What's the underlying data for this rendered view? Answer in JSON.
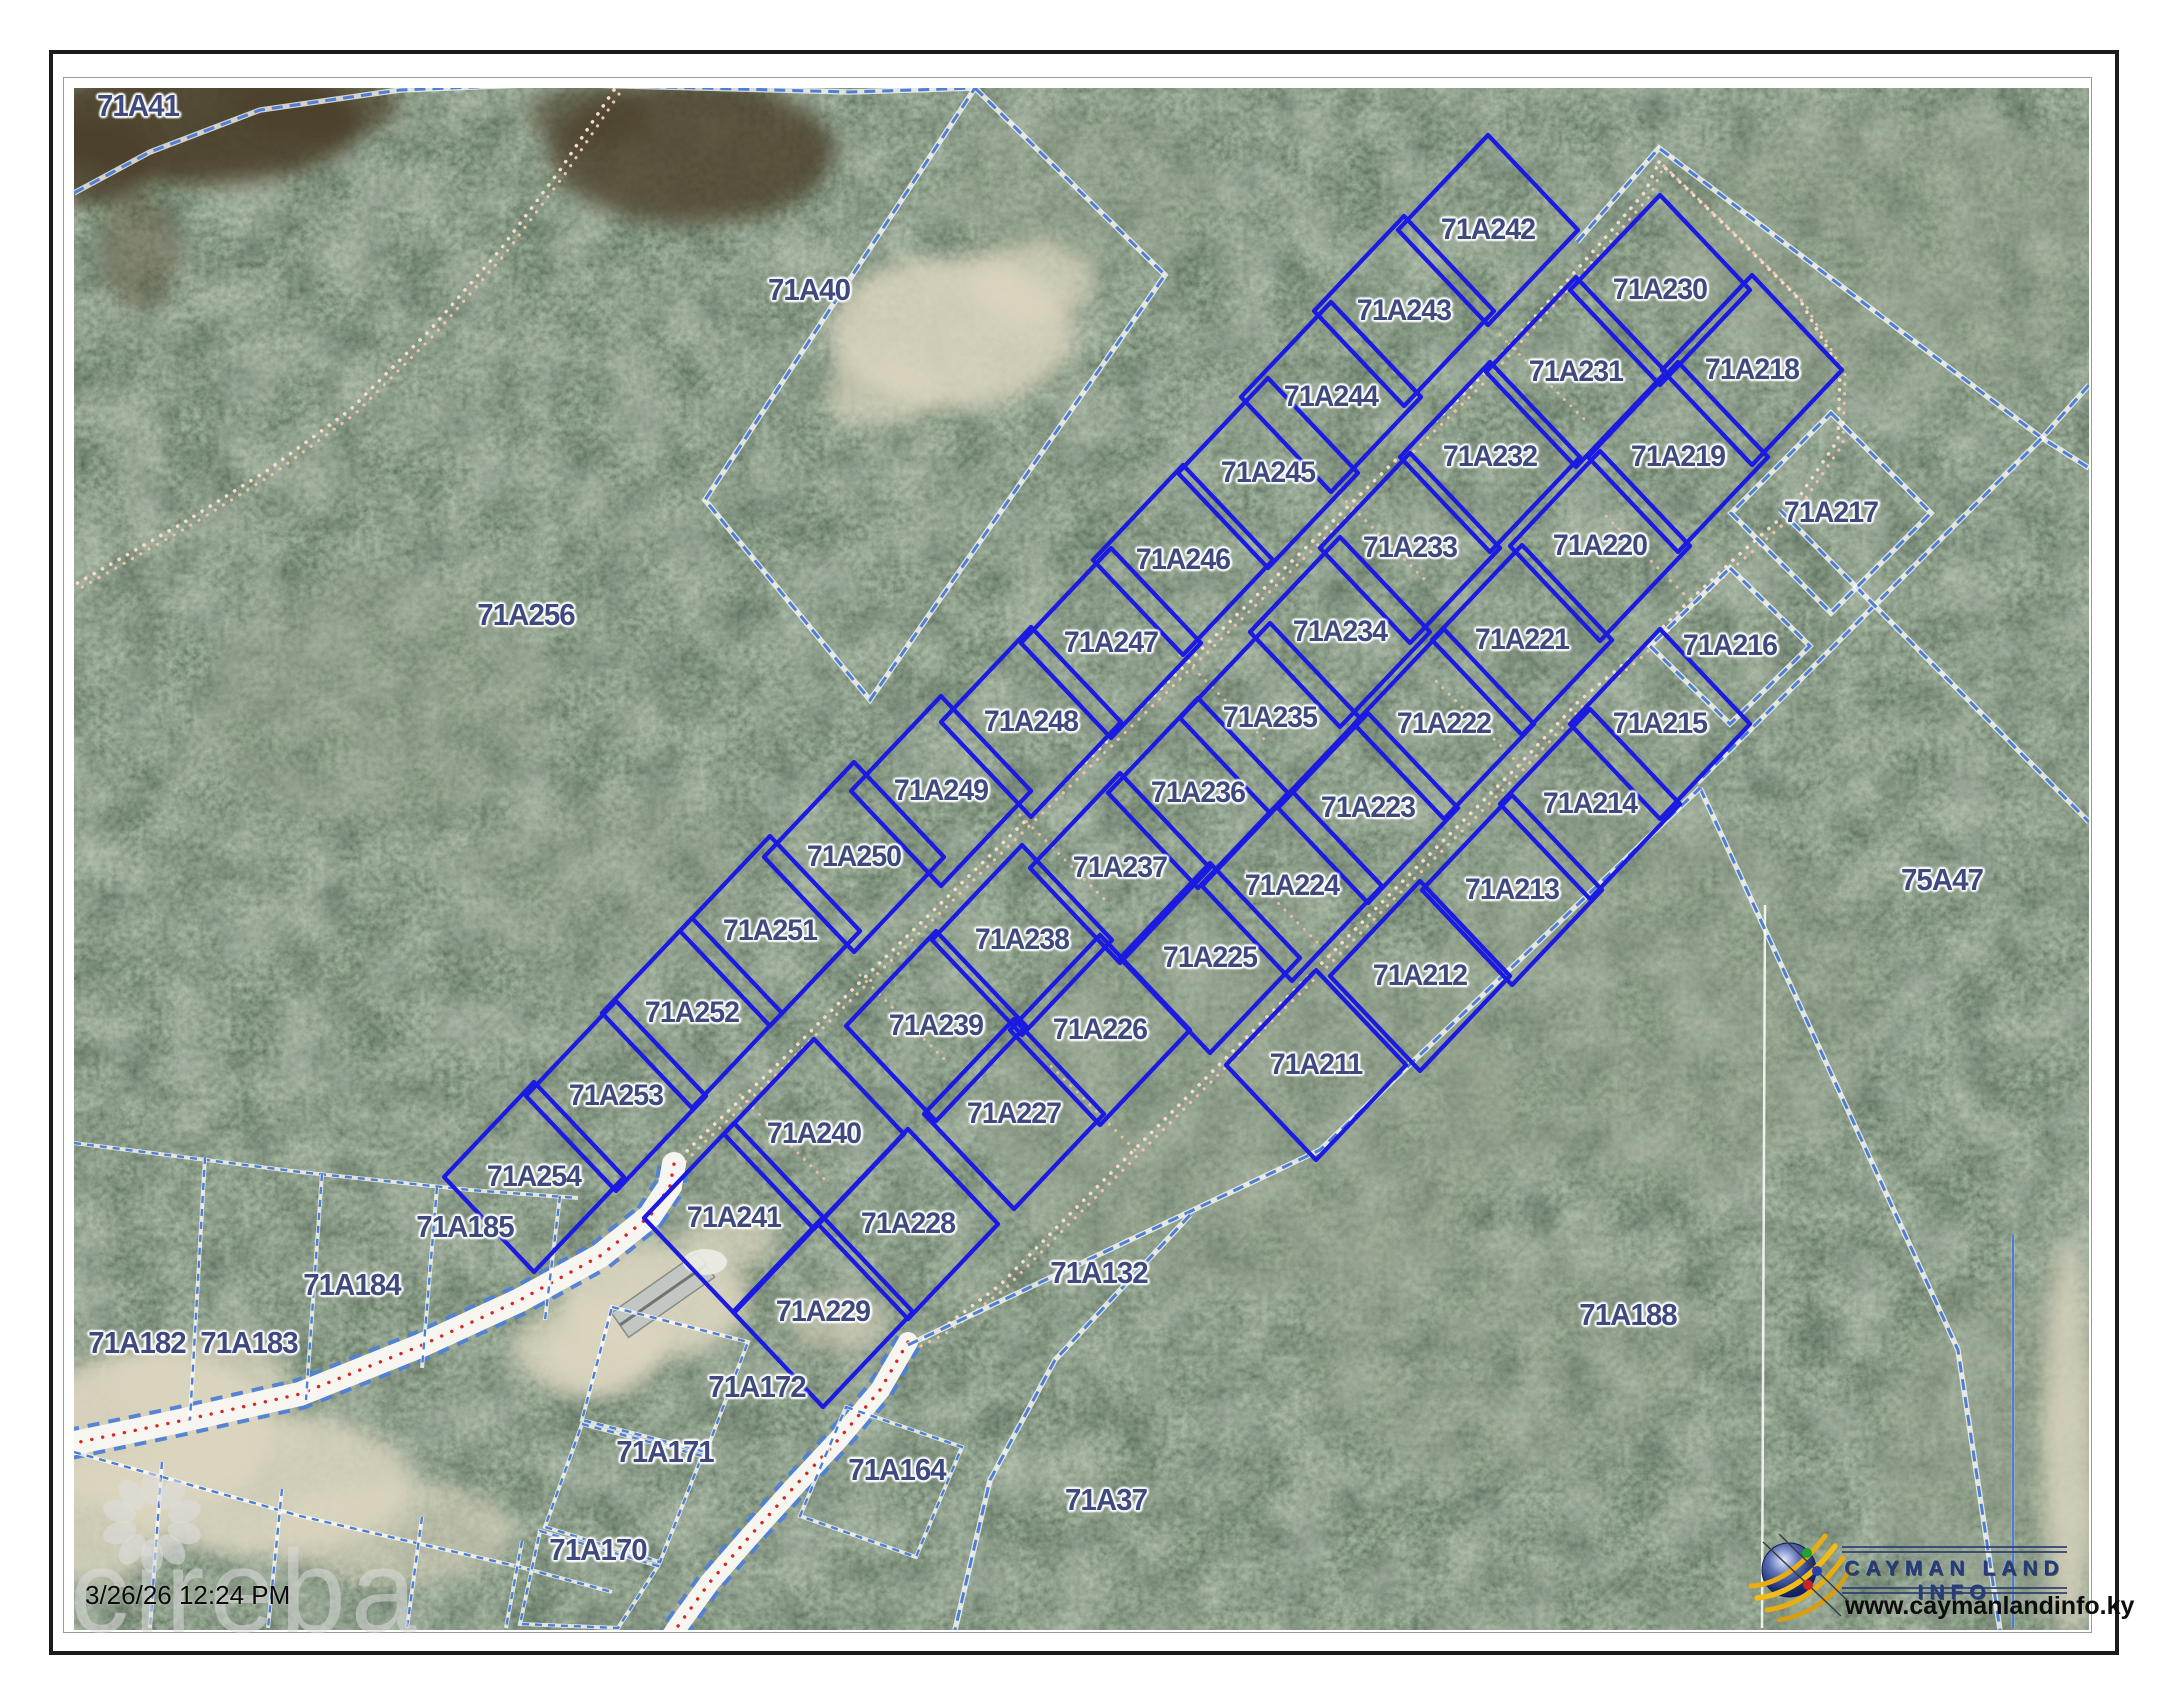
{
  "page": {
    "timestamp": "3/26/26 12:24 PM",
    "watermark": "cireba"
  },
  "logo": {
    "title": "CAYMAN LAND INFO",
    "url": "www.caymanlandinfo.ky"
  },
  "colors": {
    "lot_line": "#1a1ae0",
    "boundary_dash": "#4f7fd4",
    "label_text": "#3e4a7d",
    "road_centerline": "#d62828",
    "track_dot": "#eec3ab",
    "pavement": "#f7f5ef",
    "sand": "#dcd6c0",
    "water_dark": "#4c3f29",
    "vegetation": "#39452f"
  },
  "parcels": {
    "lots": [
      {
        "id": "71A242",
        "x": 1488,
        "y": 230
      },
      {
        "id": "71A243",
        "x": 1404,
        "y": 311
      },
      {
        "id": "71A244",
        "x": 1331,
        "y": 397
      },
      {
        "id": "71A245",
        "x": 1268,
        "y": 473
      },
      {
        "id": "71A246",
        "x": 1183,
        "y": 560
      },
      {
        "id": "71A247",
        "x": 1111,
        "y": 643
      },
      {
        "id": "71A248",
        "x": 1031,
        "y": 722
      },
      {
        "id": "71A249",
        "x": 941,
        "y": 791
      },
      {
        "id": "71A250",
        "x": 854,
        "y": 857
      },
      {
        "id": "71A251",
        "x": 770,
        "y": 931
      },
      {
        "id": "71A252",
        "x": 692,
        "y": 1013
      },
      {
        "id": "71A253",
        "x": 616,
        "y": 1096
      },
      {
        "id": "71A254",
        "x": 534,
        "y": 1177
      },
      {
        "id": "71A230",
        "x": 1660,
        "y": 290
      },
      {
        "id": "71A231",
        "x": 1576,
        "y": 372
      },
      {
        "id": "71A232",
        "x": 1490,
        "y": 457
      },
      {
        "id": "71A233",
        "x": 1410,
        "y": 548
      },
      {
        "id": "71A234",
        "x": 1340,
        "y": 632
      },
      {
        "id": "71A235",
        "x": 1270,
        "y": 718
      },
      {
        "id": "71A236",
        "x": 1198,
        "y": 793
      },
      {
        "id": "71A237",
        "x": 1120,
        "y": 868
      },
      {
        "id": "71A238",
        "x": 1022,
        "y": 940
      },
      {
        "id": "71A239",
        "x": 936,
        "y": 1026
      },
      {
        "id": "71A240",
        "x": 814,
        "y": 1134
      },
      {
        "id": "71A241",
        "x": 734,
        "y": 1218
      },
      {
        "id": "71A218",
        "x": 1752,
        "y": 370
      },
      {
        "id": "71A219",
        "x": 1678,
        "y": 457
      },
      {
        "id": "71A220",
        "x": 1600,
        "y": 546
      },
      {
        "id": "71A221",
        "x": 1522,
        "y": 640
      },
      {
        "id": "71A222",
        "x": 1444,
        "y": 724
      },
      {
        "id": "71A223",
        "x": 1368,
        "y": 808
      },
      {
        "id": "71A224",
        "x": 1292,
        "y": 886
      },
      {
        "id": "71A225",
        "x": 1210,
        "y": 958
      },
      {
        "id": "71A226",
        "x": 1100,
        "y": 1030
      },
      {
        "id": "71A227",
        "x": 1014,
        "y": 1114
      },
      {
        "id": "71A228",
        "x": 908,
        "y": 1224
      },
      {
        "id": "71A229",
        "x": 823,
        "y": 1312
      },
      {
        "id": "71A215",
        "x": 1660,
        "y": 724
      },
      {
        "id": "71A214",
        "x": 1590,
        "y": 804
      },
      {
        "id": "71A213",
        "x": 1512,
        "y": 890
      },
      {
        "id": "71A212",
        "x": 1420,
        "y": 976
      },
      {
        "id": "71A211",
        "x": 1316,
        "y": 1065
      }
    ],
    "dashed_lots": [
      {
        "id": "71A216",
        "x": 1730,
        "y": 646,
        "hx": 80,
        "hy": 78
      },
      {
        "id": "71A217",
        "x": 1831,
        "y": 513,
        "hx": 100,
        "hy": 100
      }
    ],
    "context": [
      {
        "id": "71A41",
        "x": 138,
        "y": 106
      },
      {
        "id": "71A40",
        "x": 809,
        "y": 290
      },
      {
        "id": "71A256",
        "x": 526,
        "y": 615
      },
      {
        "id": "75A47",
        "x": 1942,
        "y": 880
      },
      {
        "id": "71A185",
        "x": 465,
        "y": 1227
      },
      {
        "id": "71A184",
        "x": 352,
        "y": 1285
      },
      {
        "id": "71A183",
        "x": 249,
        "y": 1343
      },
      {
        "id": "71A182",
        "x": 137,
        "y": 1343
      },
      {
        "id": "71A132",
        "x": 1099,
        "y": 1273
      },
      {
        "id": "71A188",
        "x": 1628,
        "y": 1315
      },
      {
        "id": "71A172",
        "x": 757,
        "y": 1387
      },
      {
        "id": "71A171",
        "x": 665,
        "y": 1452
      },
      {
        "id": "71A164",
        "x": 897,
        "y": 1470
      },
      {
        "id": "71A37",
        "x": 1106,
        "y": 1500
      },
      {
        "id": "71A170",
        "x": 598,
        "y": 1550
      }
    ],
    "lot_half_diagonals": {
      "hx": 90,
      "hy": 95
    }
  },
  "geometry": {
    "tracks": {
      "t0": [
        [
          614,
          90
        ],
        [
          560,
          170
        ],
        [
          500,
          250
        ],
        [
          430,
          330
        ],
        [
          350,
          410
        ],
        [
          268,
          470
        ],
        [
          188,
          520
        ],
        [
          118,
          560
        ],
        [
          74,
          585
        ]
      ],
      "t1": [
        [
          660,
          1178
        ],
        [
          700,
          1138
        ],
        [
          780,
          1062
        ],
        [
          856,
          986
        ],
        [
          936,
          908
        ],
        [
          1014,
          832
        ],
        [
          1092,
          756
        ],
        [
          1170,
          680
        ],
        [
          1248,
          604
        ],
        [
          1326,
          528
        ],
        [
          1404,
          452
        ],
        [
          1482,
          376
        ],
        [
          1548,
          302
        ],
        [
          1605,
          238
        ],
        [
          1645,
          192
        ],
        [
          1659,
          162
        ]
      ],
      "t2": [
        [
          1659,
          162
        ],
        [
          1730,
          230
        ],
        [
          1800,
          300
        ],
        [
          1840,
          370
        ],
        [
          1838,
          440
        ],
        [
          1790,
          510
        ],
        [
          1733,
          560
        ],
        [
          1688,
          602
        ],
        [
          1638,
          652
        ],
        [
          1578,
          702
        ],
        [
          1518,
          766
        ],
        [
          1458,
          826
        ],
        [
          1394,
          890
        ],
        [
          1330,
          955
        ],
        [
          1264,
          1020
        ],
        [
          1198,
          1086
        ],
        [
          1134,
          1150
        ],
        [
          1068,
          1216
        ],
        [
          1000,
          1285
        ],
        [
          940,
          1330
        ],
        [
          910,
          1345
        ]
      ],
      "ticks": [
        [
          1500,
          335,
          1590,
          425
        ],
        [
          1340,
          495,
          1430,
          585
        ],
        [
          1180,
          655,
          1270,
          745
        ],
        [
          1020,
          815,
          1110,
          905
        ],
        [
          860,
          975,
          950,
          1065
        ],
        [
          740,
          1095,
          830,
          1185
        ],
        [
          1690,
          600,
          1600,
          510
        ],
        [
          1520,
          765,
          1430,
          675
        ],
        [
          1330,
          955,
          1240,
          865
        ],
        [
          1135,
          1150,
          1045,
          1060
        ]
      ]
    },
    "roads": {
      "road1": {
        "w": 24,
        "pts": [
          [
            70,
            1444
          ],
          [
            180,
            1421
          ],
          [
            300,
            1394
          ],
          [
            420,
            1346
          ],
          [
            520,
            1300
          ],
          [
            600,
            1256
          ],
          [
            650,
            1216
          ],
          [
            670,
            1186
          ],
          [
            674,
            1164
          ]
        ]
      },
      "road2": {
        "w": 20,
        "pts": [
          [
            908,
            1342
          ],
          [
            880,
            1390
          ],
          [
            838,
            1440
          ],
          [
            795,
            1486
          ],
          [
            750,
            1536
          ],
          [
            710,
            1582
          ],
          [
            678,
            1626
          ],
          [
            664,
            1648
          ]
        ]
      }
    },
    "dashes": [
      {
        "pts": [
          [
            74,
            193
          ],
          [
            150,
            152
          ],
          [
            260,
            110
          ],
          [
            400,
            90
          ],
          [
            550,
            84
          ],
          [
            700,
            88
          ],
          [
            850,
            92
          ],
          [
            975,
            88
          ]
        ]
      },
      {
        "pts": [
          [
            975,
            88
          ],
          [
            1165,
            275
          ],
          [
            870,
            700
          ],
          [
            705,
            500
          ]
        ],
        "closed": true
      },
      {
        "pts": [
          [
            1577,
            242
          ],
          [
            1659,
            148
          ],
          [
            2042,
            438
          ],
          [
            2089,
            468
          ]
        ]
      },
      {
        "pts": [
          [
            2089,
            385
          ],
          [
            2042,
            438
          ],
          [
            1697,
            783
          ]
        ]
      },
      {
        "pts": [
          [
            1780,
            510
          ],
          [
            2089,
            822
          ]
        ]
      },
      {
        "pts": [
          [
            1700,
            788
          ],
          [
            1958,
            1350
          ],
          [
            2000,
            1630
          ]
        ]
      },
      {
        "pts": [
          [
            908,
            1345
          ],
          [
            1320,
            1150
          ],
          [
            1700,
            788
          ]
        ]
      },
      {
        "pts": [
          [
            1190,
            1215
          ],
          [
            1055,
            1360
          ],
          [
            990,
            1480
          ],
          [
            955,
            1630
          ]
        ]
      },
      {
        "pts": [
          [
            74,
            1143
          ],
          [
            300,
            1172
          ],
          [
            470,
            1190
          ],
          [
            578,
            1198
          ]
        ],
        "thin": true
      },
      {
        "pts": [
          [
            205,
            1157
          ],
          [
            190,
            1420
          ]
        ],
        "thin": true
      },
      {
        "pts": [
          [
            322,
            1174
          ],
          [
            306,
            1400
          ]
        ],
        "thin": true
      },
      {
        "pts": [
          [
            437,
            1187
          ],
          [
            422,
            1368
          ]
        ],
        "thin": true
      },
      {
        "pts": [
          [
            560,
            1196
          ],
          [
            545,
            1320
          ]
        ],
        "thin": true
      },
      {
        "pts": [
          [
            74,
            1452
          ],
          [
            300,
            1516
          ],
          [
            520,
            1567
          ],
          [
            612,
            1592
          ]
        ],
        "thin": true
      },
      {
        "pts": [
          [
            162,
            1462
          ],
          [
            150,
            1628
          ]
        ],
        "thin": true
      },
      {
        "pts": [
          [
            282,
            1489
          ],
          [
            268,
            1628
          ]
        ],
        "thin": true
      },
      {
        "pts": [
          [
            422,
            1517
          ],
          [
            407,
            1628
          ]
        ],
        "thin": true
      },
      {
        "pts": [
          [
            522,
            1541
          ],
          [
            506,
            1628
          ]
        ],
        "thin": true
      },
      {
        "pts": [
          [
            612,
            1307
          ],
          [
            748,
            1342
          ],
          [
            706,
            1452
          ],
          [
            582,
            1420
          ]
        ],
        "closed": true,
        "thin": true
      },
      {
        "pts": [
          [
            582,
            1424
          ],
          [
            702,
            1456
          ],
          [
            660,
            1562
          ],
          [
            545,
            1527
          ]
        ],
        "closed": true,
        "thin": true
      },
      {
        "pts": [
          [
            846,
            1407
          ],
          [
            962,
            1447
          ],
          [
            916,
            1557
          ],
          [
            800,
            1516
          ]
        ],
        "closed": true,
        "thin": true
      },
      {
        "pts": [
          [
            540,
            1531
          ],
          [
            658,
            1566
          ],
          [
            618,
            1628
          ],
          [
            520,
            1624
          ]
        ],
        "closed": true,
        "thin": true
      }
    ],
    "white_lines": [
      [
        1765,
        905,
        1762,
        1628
      ],
      [
        2013,
        1235,
        2013,
        1628
      ]
    ],
    "terrain": {
      "sand": [
        [
          655,
          1300,
          95,
          58,
          0.9
        ],
        [
          588,
          1348,
          75,
          46,
          0.8
        ],
        [
          730,
          1240,
          48,
          30,
          0.7
        ],
        [
          150,
          1432,
          125,
          82,
          0.92
        ],
        [
          262,
          1484,
          150,
          72,
          0.85
        ],
        [
          92,
          1524,
          72,
          60,
          0.8
        ],
        [
          392,
          1532,
          122,
          52,
          0.6
        ],
        [
          205,
          1382,
          85,
          45,
          0.7
        ],
        [
          952,
          332,
          122,
          76,
          0.85
        ],
        [
          1032,
          282,
          62,
          42,
          0.7
        ],
        [
          882,
          392,
          56,
          36,
          0.6
        ],
        [
          838,
          1322,
          48,
          30,
          0.6
        ],
        [
          600,
          1355,
          55,
          38,
          0.7
        ],
        [
          2068,
          1440,
          26,
          200,
          0.8
        ]
      ],
      "dark": [
        [
          200,
          122,
          160,
          62,
          0.9
        ],
        [
          92,
          162,
          62,
          42,
          0.85
        ],
        [
          318,
          106,
          82,
          32,
          0.75
        ],
        [
          692,
          152,
          142,
          72,
          0.8
        ],
        [
          590,
          116,
          62,
          32,
          0.6
        ],
        [
          140,
          250,
          40,
          60,
          0.4
        ]
      ],
      "pale": [
        [
          375,
          700,
          175,
          125,
          0.3
        ],
        [
          1250,
          1120,
          265,
          175,
          0.35
        ],
        [
          1655,
          1005,
          225,
          185,
          0.3
        ],
        [
          1905,
          252,
          235,
          145,
          0.32
        ],
        [
          2005,
          1450,
          125,
          165,
          0.35
        ],
        [
          1082,
          192,
          142,
          82,
          0.28
        ],
        [
          612,
          882,
          142,
          92,
          0.22
        ],
        [
          1500,
          1350,
          200,
          120,
          0.25
        ]
      ],
      "house": {
        "poly": [
          [
            697.4,
            1252.6
          ],
          [
            714.6,
            1277.2
          ],
          [
            628.6,
            1337.4
          ],
          [
            611.4,
            1312.8
          ]
        ],
        "ridge": [
          706,
          1265,
          620,
          1325
        ],
        "blob": [
          705,
          1262,
          22,
          13
        ]
      }
    }
  }
}
